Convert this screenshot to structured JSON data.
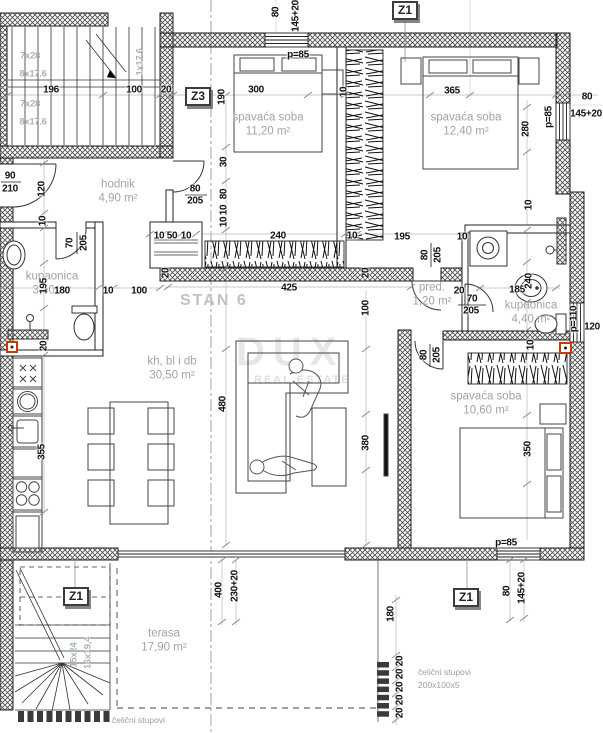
{
  "plan": {
    "unit_label": "STAN 6",
    "watermark": {
      "line1": "DUX",
      "line2": "REAL ESTATE"
    },
    "colors": {
      "wall_hatch": "#4f4f4f",
      "dimension_text": "#111111",
      "room_text": "#a3a3a3",
      "marker_border": "#3c3c3c",
      "accent": "#cc3a00"
    },
    "rooms": [
      {
        "name": "hodnik",
        "area": "4,90 m²",
        "x": 118,
        "y": 192
      },
      {
        "name": "spavaća soba",
        "area": "11,20 m²",
        "x": 268,
        "y": 125
      },
      {
        "name": "spavaća soba",
        "area": "12,40 m²",
        "x": 466,
        "y": 125
      },
      {
        "name": "kupaonica",
        "area": "3,50 m²",
        "x": 52,
        "y": 284
      },
      {
        "name": "pred.",
        "area": "1,20 m²",
        "x": 432,
        "y": 295
      },
      {
        "name": "kupaonica",
        "area": "4,40 m²",
        "x": 531,
        "y": 313
      },
      {
        "name": "kh, bl i db",
        "area": "30,50 m²",
        "x": 172,
        "y": 369
      },
      {
        "name": "spavaća soba",
        "area": "10,60 m²",
        "x": 486,
        "y": 404
      },
      {
        "name": "terasa",
        "area": "17,90 m²",
        "x": 164,
        "y": 641
      }
    ],
    "markers": [
      {
        "label": "Z1",
        "x": 392,
        "y": 1
      },
      {
        "label": "Z3",
        "x": 185,
        "y": 87
      },
      {
        "label": "Z1",
        "x": 63,
        "y": 587
      },
      {
        "label": "Z1",
        "x": 453,
        "y": 588
      }
    ],
    "dims": [
      {
        "t": "196",
        "x": 51,
        "y": 90
      },
      {
        "t": "100",
        "x": 134,
        "y": 90
      },
      {
        "t": "20",
        "x": 166,
        "y": 90
      },
      {
        "t": "300",
        "x": 256,
        "y": 90
      },
      {
        "t": "190",
        "x": 222,
        "y": 97,
        "r": 1
      },
      {
        "t": "80",
        "x": 276,
        "y": 12,
        "r": 1
      },
      {
        "t": "145+20",
        "x": 296,
        "y": 16,
        "r": 1
      },
      {
        "t": "p=85",
        "x": 298,
        "y": 55
      },
      {
        "t": "10",
        "x": 344,
        "y": 92,
        "r": 1
      },
      {
        "t": "365",
        "x": 452,
        "y": 91
      },
      {
        "t": "280",
        "x": 526,
        "y": 129,
        "r": 1
      },
      {
        "t": "80",
        "x": 587,
        "y": 97
      },
      {
        "t": "145+20",
        "x": 586,
        "y": 114
      },
      {
        "t": "p=85",
        "x": 549,
        "y": 117,
        "r": 1
      },
      {
        "t": "30",
        "x": 224,
        "y": 162,
        "r": 1
      },
      {
        "t": "80",
        "x": 195,
        "y": 189
      },
      {
        "t": "205",
        "x": 195,
        "y": 201
      },
      {
        "t": "80",
        "x": 224,
        "y": 194,
        "r": 1
      },
      {
        "t": "10",
        "x": 224,
        "y": 210,
        "r": 1
      },
      {
        "t": "10",
        "x": 224,
        "y": 222,
        "r": 1
      },
      {
        "t": "90",
        "x": 10,
        "y": 176
      },
      {
        "t": "210",
        "x": 10,
        "y": 189
      },
      {
        "t": "120",
        "x": 42,
        "y": 189,
        "r": 1
      },
      {
        "t": "10",
        "x": 43,
        "y": 221,
        "r": 1
      },
      {
        "t": "70",
        "x": 70,
        "y": 243,
        "r": 1
      },
      {
        "t": "205",
        "x": 84,
        "y": 243,
        "r": 1
      },
      {
        "t": "195",
        "x": 44,
        "y": 286,
        "r": 1
      },
      {
        "t": "20",
        "x": 44,
        "y": 346,
        "r": 1
      },
      {
        "t": "180",
        "x": 62,
        "y": 291
      },
      {
        "t": "10",
        "x": 108,
        "y": 291
      },
      {
        "t": "100",
        "x": 139,
        "y": 291
      },
      {
        "t": "10",
        "x": 159,
        "y": 236
      },
      {
        "t": "50",
        "x": 172,
        "y": 236
      },
      {
        "t": "10",
        "x": 186,
        "y": 236
      },
      {
        "t": "240",
        "x": 278,
        "y": 236
      },
      {
        "t": "10",
        "x": 352,
        "y": 236
      },
      {
        "t": "195",
        "x": 402,
        "y": 237
      },
      {
        "t": "10",
        "x": 462,
        "y": 237
      },
      {
        "t": "20",
        "x": 166,
        "y": 273,
        "r": 1
      },
      {
        "t": "20",
        "x": 366,
        "y": 273,
        "r": 1
      },
      {
        "t": "425",
        "x": 289,
        "y": 288
      },
      {
        "t": "80",
        "x": 425,
        "y": 255,
        "r": 1
      },
      {
        "t": "205",
        "x": 438,
        "y": 255,
        "r": 1
      },
      {
        "t": "20",
        "x": 459,
        "y": 291
      },
      {
        "t": "70",
        "x": 472,
        "y": 299
      },
      {
        "t": "205",
        "x": 471,
        "y": 311
      },
      {
        "t": "185",
        "x": 517,
        "y": 290
      },
      {
        "t": "240",
        "x": 529,
        "y": 281,
        "r": 1
      },
      {
        "t": "10",
        "x": 529,
        "y": 205,
        "r": 1
      },
      {
        "t": "10",
        "x": 531,
        "y": 345,
        "r": 1
      },
      {
        "t": "p=110",
        "x": 574,
        "y": 319,
        "r": 1
      },
      {
        "t": "120",
        "x": 592,
        "y": 327
      },
      {
        "t": "100",
        "x": 366,
        "y": 308,
        "r": 1
      },
      {
        "t": "80",
        "x": 424,
        "y": 355,
        "r": 1
      },
      {
        "t": "205",
        "x": 437,
        "y": 355,
        "r": 1
      },
      {
        "t": "480",
        "x": 223,
        "y": 404,
        "r": 1
      },
      {
        "t": "380",
        "x": 366,
        "y": 443,
        "r": 1
      },
      {
        "t": "350",
        "x": 528,
        "y": 449,
        "r": 1
      },
      {
        "t": "355",
        "x": 42,
        "y": 452,
        "r": 1
      },
      {
        "t": "400",
        "x": 219,
        "y": 590,
        "r": 1
      },
      {
        "t": "230+20",
        "x": 235,
        "y": 586,
        "r": 1
      },
      {
        "t": "p=85",
        "x": 506,
        "y": 543
      },
      {
        "t": "80",
        "x": 507,
        "y": 591,
        "r": 1
      },
      {
        "t": "145+20",
        "x": 522,
        "y": 588,
        "r": 1
      },
      {
        "t": "180",
        "x": 391,
        "y": 614,
        "r": 1
      },
      {
        "t": "20",
        "x": 400,
        "y": 661,
        "r": 1
      },
      {
        "t": "20",
        "x": 400,
        "y": 674,
        "r": 1
      },
      {
        "t": "20",
        "x": 400,
        "y": 687,
        "r": 1
      },
      {
        "t": "20",
        "x": 400,
        "y": 700,
        "r": 1
      },
      {
        "t": "20",
        "x": 400,
        "y": 713,
        "r": 1
      }
    ],
    "stair_labels": [
      {
        "t": "7x28",
        "x": 30,
        "y": 56
      },
      {
        "t": "8x17.6",
        "x": 33,
        "y": 74
      },
      {
        "t": "7x28",
        "x": 30,
        "y": 104
      },
      {
        "t": "8x17.6",
        "x": 33,
        "y": 122
      },
      {
        "t": "1x17.6",
        "x": 140,
        "y": 62,
        "r": 1
      },
      {
        "t": "15x24",
        "x": 74,
        "y": 655,
        "r": 1
      },
      {
        "t": "16x19,4",
        "x": 88,
        "y": 653,
        "r": 1
      }
    ],
    "notes": [
      {
        "text": "čelični stupovi",
        "x": 418,
        "y": 672
      },
      {
        "text": "200x100x5",
        "x": 418,
        "y": 685
      },
      {
        "text": "čelični stupovi",
        "x": 112,
        "y": 720
      }
    ]
  }
}
